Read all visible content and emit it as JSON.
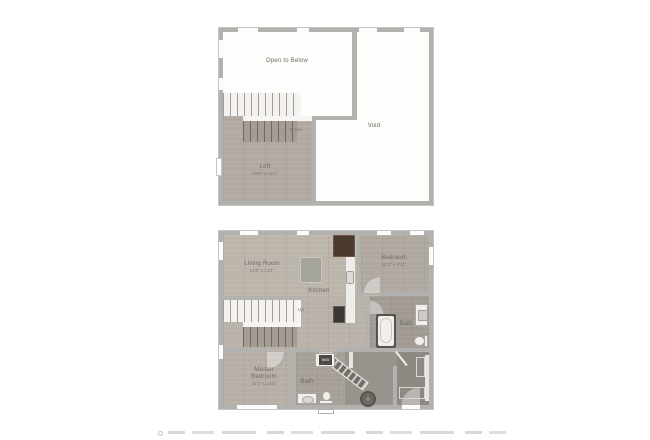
{
  "colors": {
    "wall": "#b3b1ae",
    "floor-wood": "#b8b2aa",
    "floor-white": "#fdfdfc",
    "floor-dark": "#8e8983",
    "island": "#a5a49a",
    "appliance-dark": "#3b3835",
    "fridge-brown": "#4a392d",
    "label-text": "#6f6a63"
  },
  "upper_plan": {
    "open_to_below_label": "Open to Below",
    "void_label": "Void",
    "loft_label": "Loft",
    "loft_dims": "15'9\" x 16'1\"",
    "stairs_label": "Down"
  },
  "main_plan": {
    "living_room_label": "Living Room",
    "living_room_dims": "13'8\" x 13'1\"",
    "kitchen_label": "Kitchen",
    "bedroom_label": "Bedroom",
    "bedroom_dims": "12'4\" x 9'11\"",
    "bath_right_label": "Bath",
    "bath_lower_label": "Bath",
    "master_bedroom_label": "Master Bedroom",
    "master_bedroom_dims": "11'2\" x 14'5\"",
    "stairs_label": "Up",
    "washer_dryer_label": "W/D"
  }
}
